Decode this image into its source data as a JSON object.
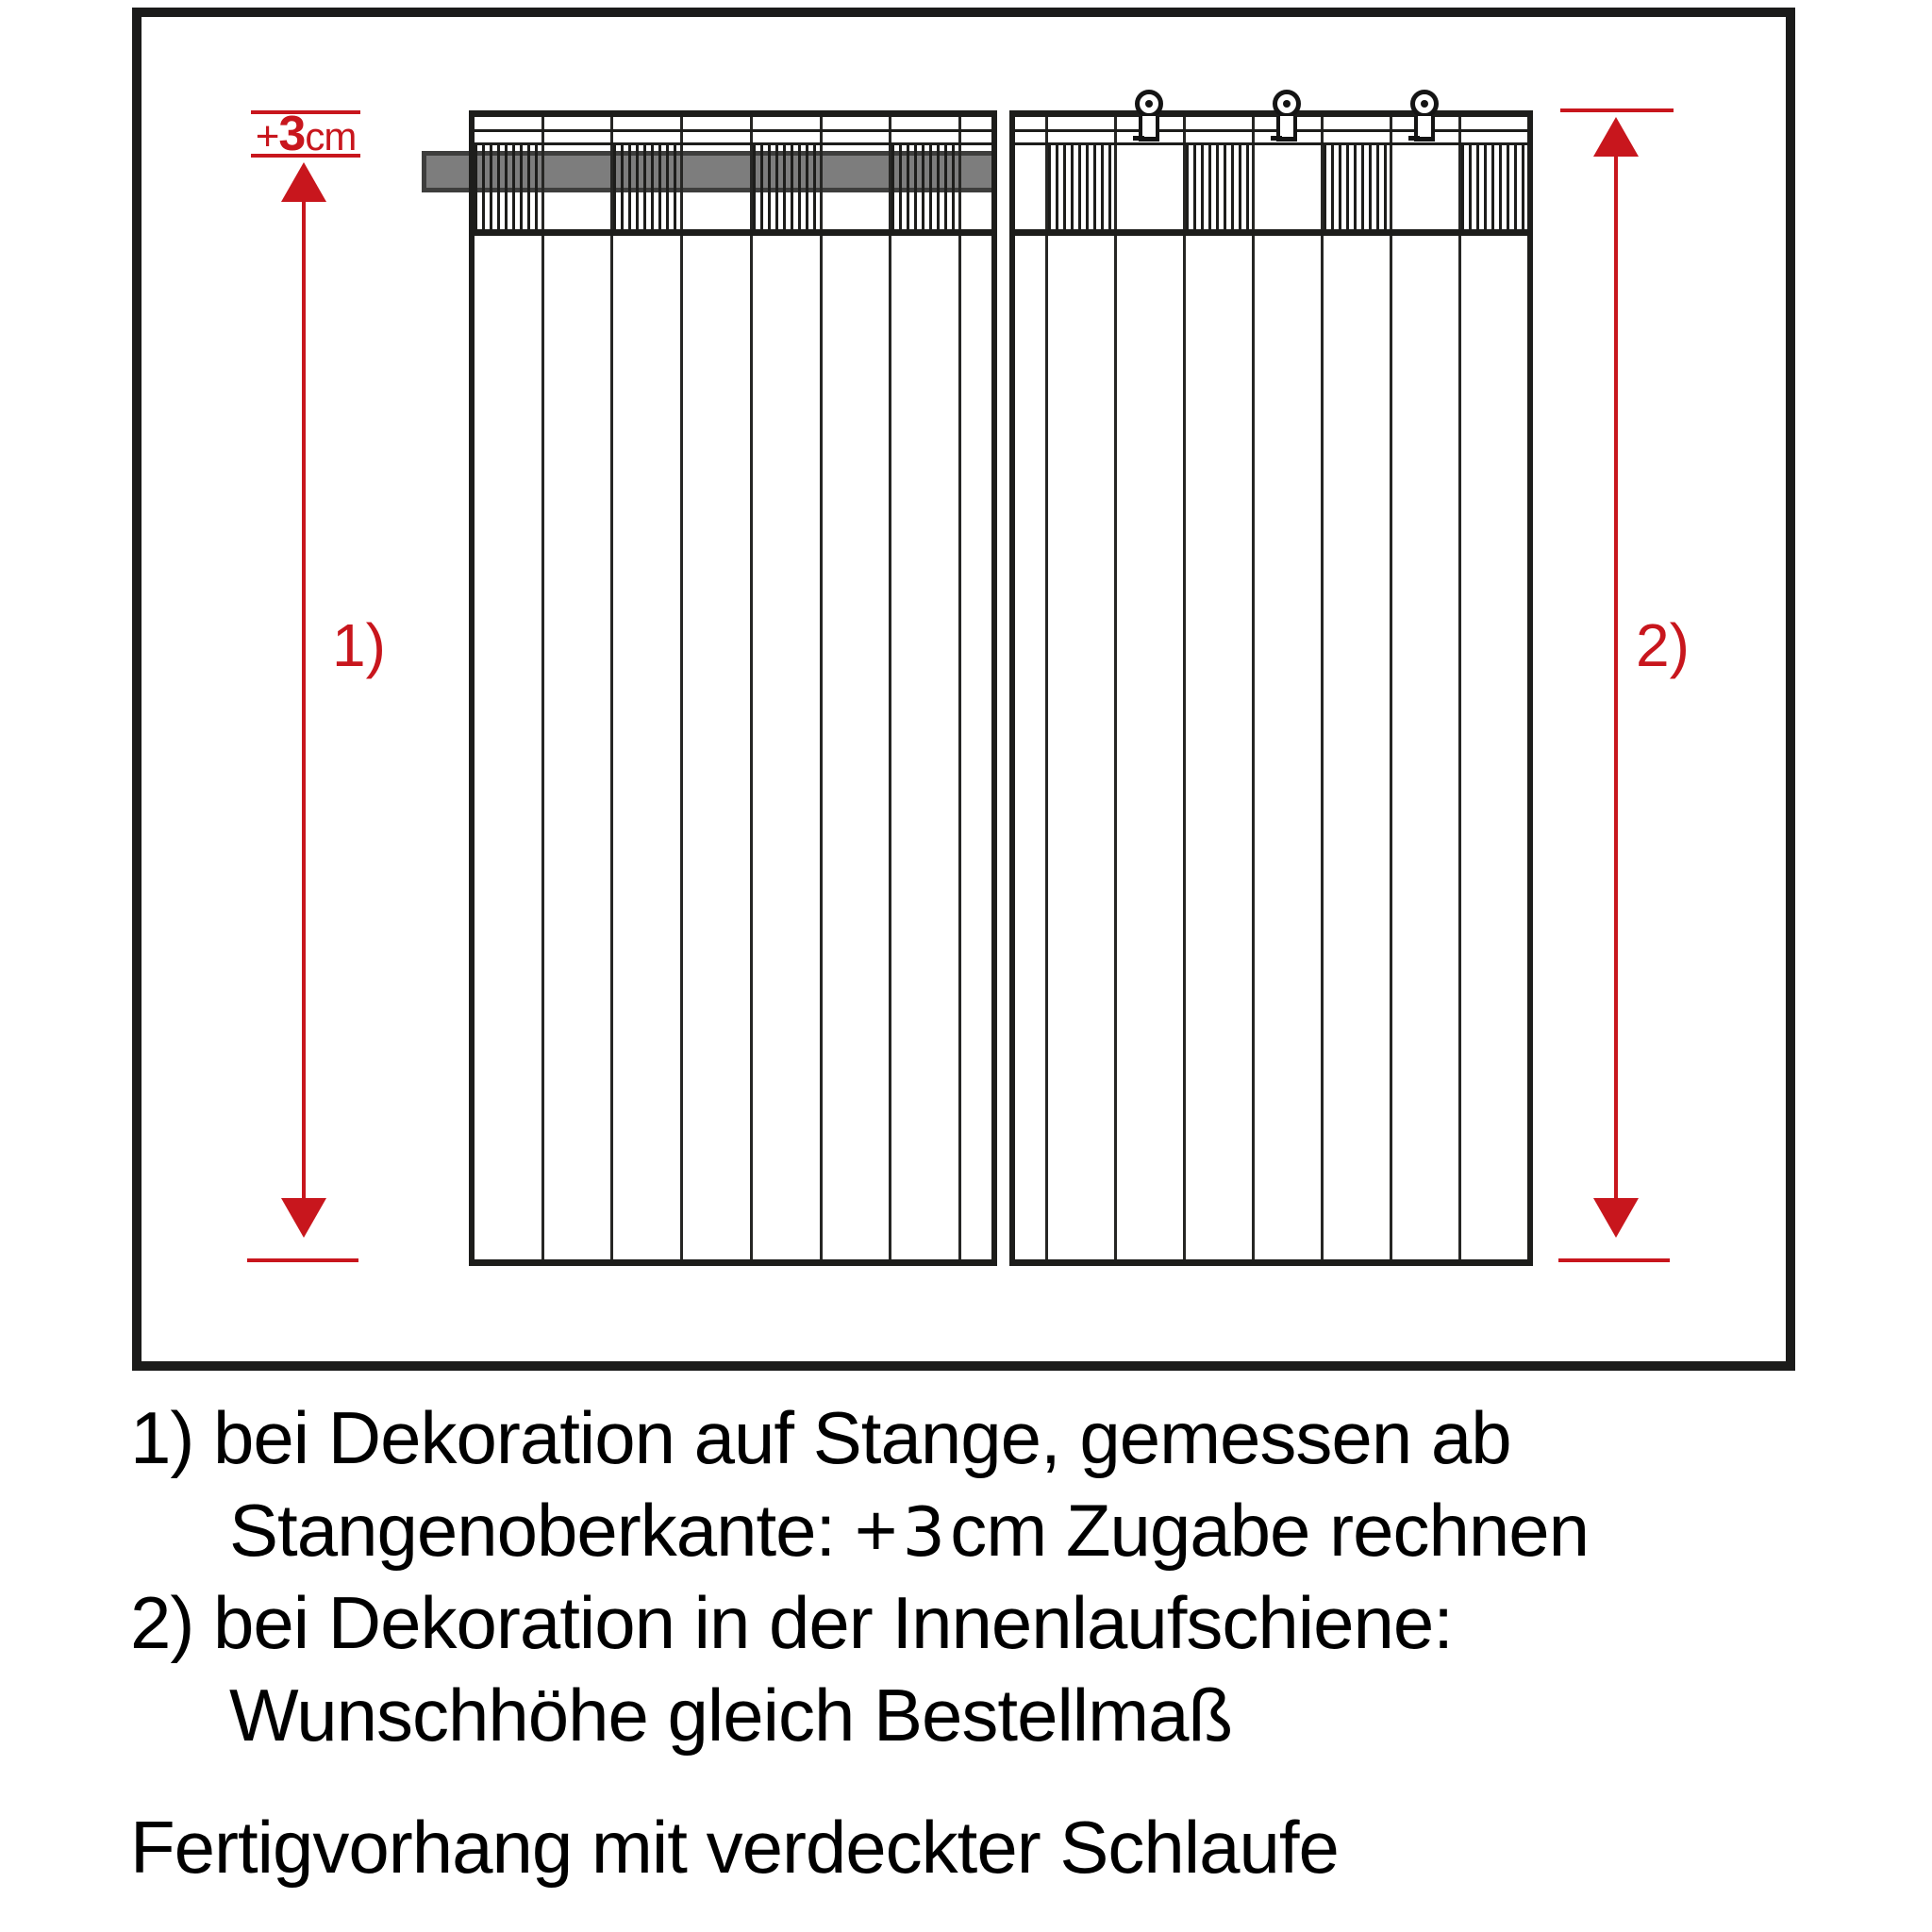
{
  "diagram": {
    "top_allowance": {
      "plus": "+",
      "value": "3",
      "unit": "cm"
    },
    "arrow_left_label": "1)",
    "arrow_right_label": "2)"
  },
  "notes": {
    "line1": "1) bei Dekoration auf Stange, gemessen ab",
    "line2_pre": "Stangenoberkante: +",
    "line2_value": "3",
    "line2_post": "cm Zugabe rechnen",
    "line3": "2) bei Dekoration in der Innenlaufschiene:",
    "line4": "Wunschhöhe gleich Bestellmaß",
    "footer": "Fertigvorhang mit verdeckter Schlaufe"
  },
  "colors": {
    "accent_red": "#c8161d",
    "rod_gray": "#7d7d7d",
    "line_black": "#1d1d1b"
  }
}
